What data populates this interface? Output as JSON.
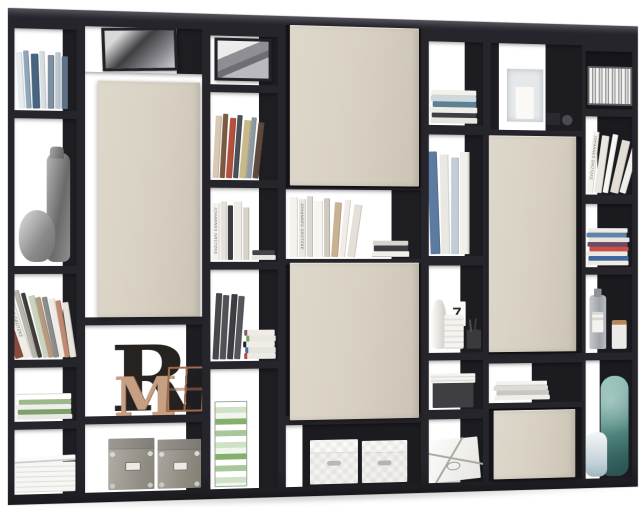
{
  "image": {
    "type": "product-photo",
    "subject": "Black open room-divider shelving unit styled with books and decor, five sand-beige doors",
    "background": "#ffffff"
  },
  "palette": {
    "frame": "#26252b",
    "door": "#d7d0c2",
    "interior_shadow": "#1d1d22",
    "wood_accent": "#c79f82",
    "teal_accent": "#5f958d",
    "concrete_grey": "#8a8a8a"
  },
  "texts": {
    "letter_r": "R",
    "letter_m": "M",
    "vase_digit": "7",
    "spine_innenarchitektur": "INNENARCHITEKTUR",
    "spine_gruetzke_1": "JOHANNES GRÜTZKE",
    "spine_gruetzke_2": "JOHANNES GRÜTZKE",
    "spine_gruetzke_3": "JOHANNES GRÜTZKE"
  },
  "shelf": {
    "doors": [
      {
        "id": "A",
        "position": "left column, tall",
        "color": "#d7d0c2"
      },
      {
        "id": "B",
        "position": "middle column, top",
        "color": "#d7d0c2"
      },
      {
        "id": "C",
        "position": "middle column, lower",
        "color": "#d7d0c2"
      },
      {
        "id": "D",
        "position": "right-centre column, tall",
        "color": "#d7d0c2"
      },
      {
        "id": "E",
        "position": "right-centre column, bottom drawer",
        "color": "#d7d0c2"
      }
    ],
    "columns": [
      {
        "id": 1,
        "compartments": [
          "row of standing media cases",
          "tall grey concrete vase and round grey pot",
          "row of leaning books",
          "small pile of magazines",
          "stack of newspapers"
        ]
      },
      {
        "id": 2,
        "compartments": [
          "black & white photo frame",
          "door A",
          "decorative letters R and M with copper wire lantern",
          "two grey storage boxes with chrome corners"
        ]
      },
      {
        "id": 3,
        "compartments": [
          "framed mountain photo",
          "standing art books",
          "white books with flat book stack",
          "dark media slipcases and magazine pile",
          "tall stack of green-white dvd cases"
        ]
      },
      {
        "id": 4,
        "compartments": [
          "door B",
          "standing white books and flat stacked books",
          "door C",
          "two white quilted storage boxes"
        ]
      },
      {
        "id": 5,
        "compartments": [
          "flat pile of books",
          "leaning oversized books",
          "white vases, number 7 card, pencil cup",
          "grey box with papers on top",
          "white gift-wrapped box with twine bow"
        ]
      },
      {
        "id": 6,
        "compartments": [
          "glass hurricane with white pillar candle and dark votives",
          "door D",
          "flat pile of papers",
          "drawer front E"
        ]
      },
      {
        "id": 7,
        "compartments": [
          "wire file rack with papers",
          "leaning white books",
          "pile of colourful magazines",
          "glass bottle with label and candle jar with wooden lid",
          "tall teal art vase and small white vase"
        ]
      }
    ]
  }
}
